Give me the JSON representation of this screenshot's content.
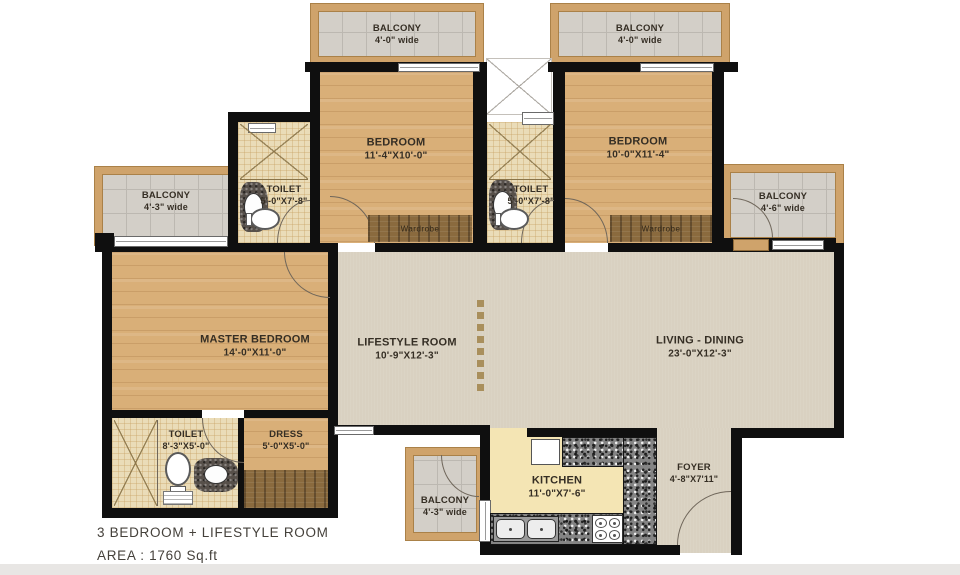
{
  "plan": {
    "title_line1": "3 BEDROOM + LIFESTYLE ROOM",
    "title_line2": "AREA : 1760 Sq.ft"
  },
  "rooms": {
    "bedroom1": {
      "name": "BEDROOM",
      "dims": "11'-4\"X10'-0\""
    },
    "bedroom2": {
      "name": "BEDROOM",
      "dims": "10'-0\"X11'-4\""
    },
    "master_bedroom": {
      "name": "MASTER BEDROOM",
      "dims": "14'-0\"X11'-0\""
    },
    "lifestyle_room": {
      "name": "LIFESTYLE ROOM",
      "dims": "10'-9\"X12'-3\""
    },
    "living_dining": {
      "name": "LIVING - DINING",
      "dims": "23'-0\"X12'-3\""
    },
    "kitchen": {
      "name": "KITCHEN",
      "dims": "11'-0\"X7'-6\""
    },
    "foyer": {
      "name": "FOYER",
      "dims": "4'-8\"X7'11\""
    },
    "toilet_bed1": {
      "name": "TOILET",
      "dims": "5'-0\"X7'-8\""
    },
    "toilet_bed2": {
      "name": "TOILET",
      "dims": "5'-0\"X7'-8\""
    },
    "toilet_master": {
      "name": "TOILET",
      "dims": "8'-3\"X5'-0\""
    },
    "dress": {
      "name": "DRESS",
      "dims": "5'-0\"X5'-0\""
    }
  },
  "balconies": {
    "top_left": {
      "name": "BALCONY",
      "size": "4'-0\" wide"
    },
    "top_right": {
      "name": "BALCONY",
      "size": "4'-0\" wide"
    },
    "left": {
      "name": "BALCONY",
      "size": "4'-3\" wide"
    },
    "right": {
      "name": "BALCONY",
      "size": "4'-6\" wide"
    },
    "bottom": {
      "name": "BALCONY",
      "size": "4'-3\" wide"
    }
  },
  "labels": {
    "wardrobe": "Wardrobe"
  },
  "colors": {
    "wall": "#0f0f0f",
    "wood_floor": "#d9af78",
    "living_floor": "#d9d1c1",
    "toilet_floor": "#eadcb8",
    "balcony_floor": "#d3cfc8",
    "balcony_frame": "#cfa36b",
    "kitchen_floor": "#f4e5b4",
    "granite_counter": "#848484",
    "wardrobe_wood": "#8a6a3e"
  }
}
